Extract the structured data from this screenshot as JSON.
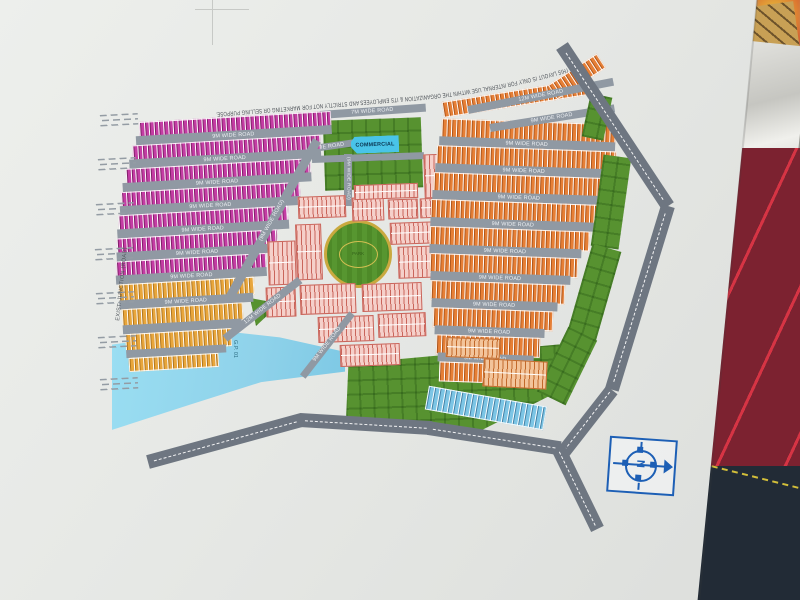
{
  "map": {
    "disclaimer": "THIS LAYOUT IS ONLY FOR INTERNAL USE WITHIN THE ORGANIZATION & ITS EMPLOYEES AND STRICTLY NOT FOR MARKETING OR SELLING PURPOSE.",
    "labels": {
      "commercial": "COMMERCIAL",
      "park": "PARK",
      "water": "G.P. 01",
      "exist_junction": "EXIST. JUNCTION (ROAD)",
      "compass_n": "N"
    },
    "roads": {
      "r7": "7M WIDE ROAD",
      "r9": "9M WIDE ROAD",
      "r12": "12M WIDE ROAD",
      "r9v": "(9M WIDE ROAD)"
    },
    "colors": {
      "paper": "#e7e9e6",
      "magenta": "#c43da4",
      "yellow": "#e8a63c",
      "orange": "#e67f36",
      "pink": "#f5d0ca",
      "pinktick": "#c9655b",
      "blue": "#7cc5e5",
      "green": "#579230",
      "roadgray": "#9099a3",
      "mainroad": "#6e7681",
      "water": "#8fd2ea",
      "commercial": "#49c4e8",
      "compassblue": "#1d5fb5",
      "fabricred": "#7c2230",
      "fabricnavy": "#222b36",
      "tanobject": "#c8a055"
    }
  }
}
